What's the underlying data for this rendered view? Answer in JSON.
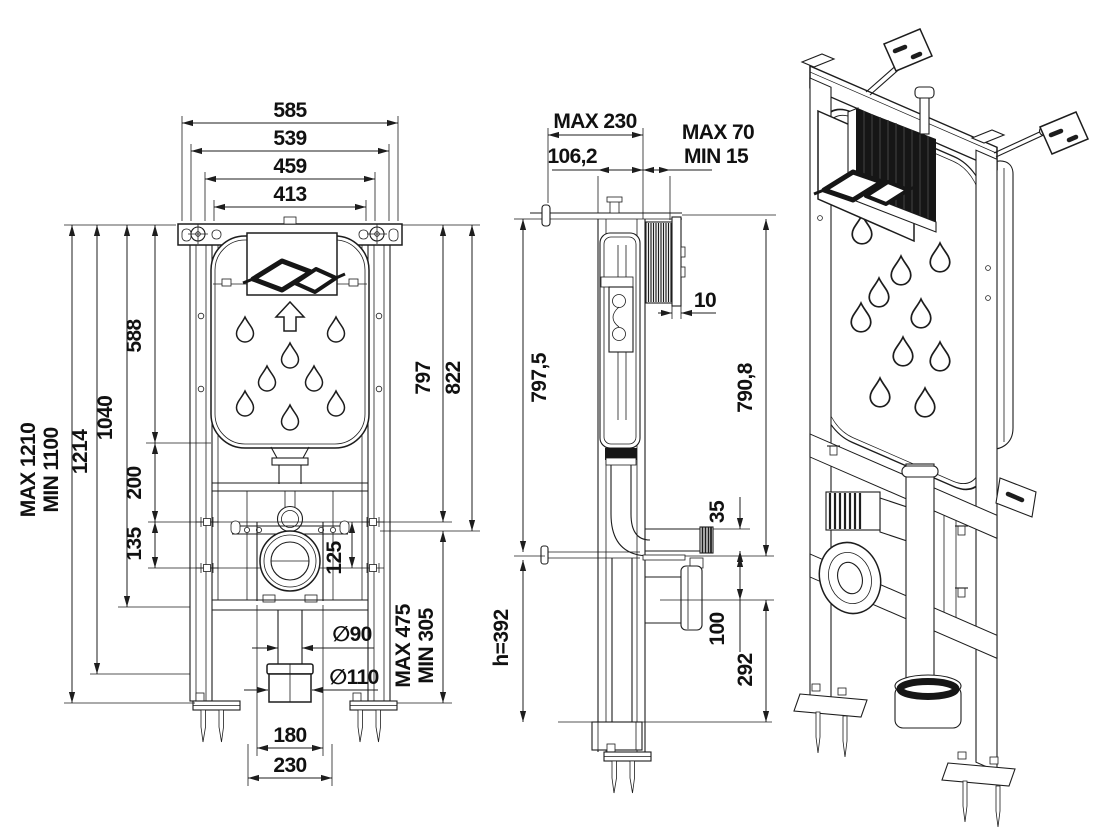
{
  "front_view": {
    "dims_top": {
      "d585": "585",
      "d539": "539",
      "d459": "459",
      "d413": "413"
    },
    "dims_left": {
      "max": "MAX 1210",
      "min": "MIN 1100",
      "d1214": "1214",
      "d1040": "1040",
      "d588": "588",
      "d200": "200",
      "d135": "135"
    },
    "dims_right": {
      "d797": "797",
      "d822": "822",
      "d125": "125",
      "max": "MAX 475",
      "min": "MIN 305"
    },
    "dims_bottom": {
      "dia90": "∅90",
      "dia110": "∅110",
      "d180": "180",
      "d230": "230"
    }
  },
  "side_view": {
    "dims_top": {
      "max230": "MAX 230",
      "d106_2": "106,2",
      "max70": "MAX 70",
      "min15": "MIN 15",
      "d10": "10"
    },
    "dims_left": {
      "d797_5": "797,5",
      "h392": "h=392"
    },
    "dims_right": {
      "d790_8": "790,8",
      "d35": "35",
      "d100": "100",
      "d292": "292"
    }
  }
}
